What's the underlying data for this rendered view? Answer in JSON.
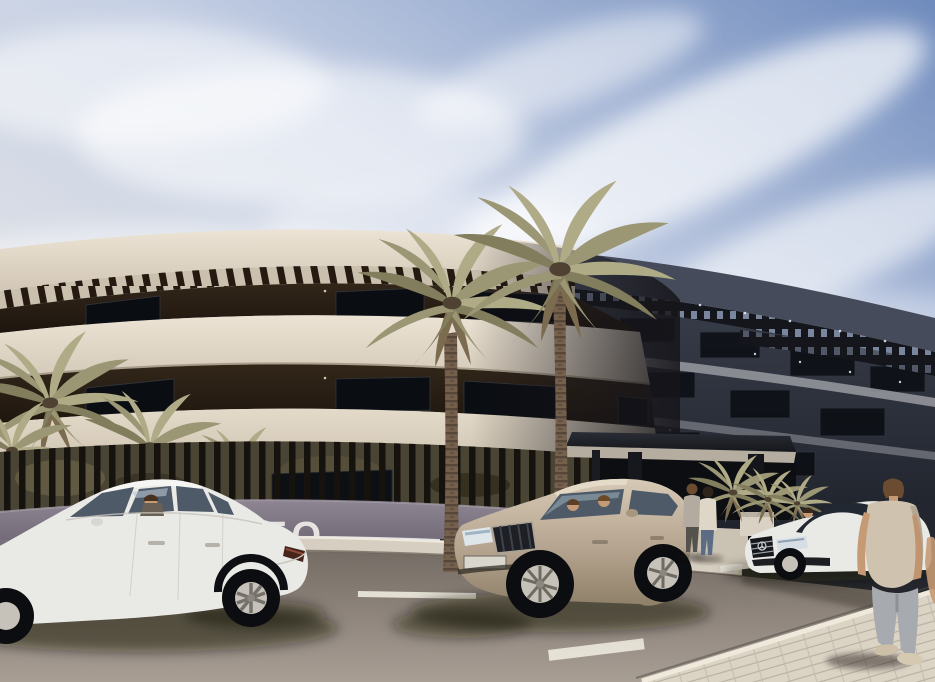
{
  "scene": {
    "type": "architectural-exterior-render",
    "time_of_day": "day",
    "wall_sign_text": "TO",
    "elements": [
      "sky with cirrus clouds",
      "curved modern apartment building, cream sunlit left side",
      "dark shadowed right wing with pergola roof slats",
      "stacked white balcony bands with dark recessed floors",
      "entrance canopy with pillars and planter",
      "black slatted perimeter fence on grey wall",
      "tall palm trees and low palm shrubs",
      "white sedan driving left",
      "champagne SUV",
      "white coupe and dark car parked right",
      "couple standing at entrance",
      "man walking away on sidewalk",
      "asphalt road with white lane dashes",
      "tiled pavement bottom right"
    ]
  },
  "palette": {
    "sky_top": "#6f8bbd",
    "sky_mid": "#c7d1e5",
    "sky_low": "#eceae6",
    "cloud": "#ffffff",
    "cream_light": "#ece3d4",
    "cream": "#d9cfbf",
    "cream_deep": "#c8bdac",
    "dark_floor": "#271d14",
    "window_glass": "#0a0d12",
    "right_top": "#454b5a",
    "right_dark": "#30343f",
    "right_line": "#94959b",
    "pergola_slat": "#241a10",
    "fence": "#16120d",
    "greenery": "#4a4434",
    "wall": "#7b7280",
    "wall_sign": "#eceae6",
    "kerb": "#d6cec0",
    "road_light": "#a69c92",
    "road_dark": "#6e665e",
    "sidewalk": "#dbd3c4",
    "tile_line": "#b7afa0",
    "car_white": "#e9e9e6",
    "car_champagne": "#bcab96",
    "car_dark_body": "#23262e",
    "vehicle_glass": "#4e5a68",
    "skin": "#c59a74",
    "hair_brown": "#6b4c30",
    "shirt_beige": "#cfc2ae",
    "jeans_grey": "#a7abb0",
    "jeans_blue": "#5c6c84",
    "jacket_grey": "#b4aba0",
    "jacket_cream": "#ded6c6",
    "palm_1": "#9b9673",
    "palm_2": "#827d5d",
    "palm_3": "#b0ab87",
    "trunk": "#74604c",
    "shadow": "#140f08"
  }
}
